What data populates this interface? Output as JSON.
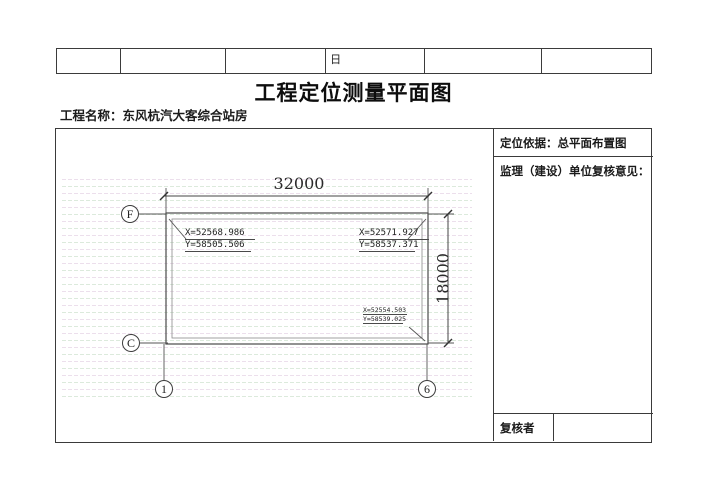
{
  "header_table": {
    "cells": [
      "",
      "",
      "",
      "日",
      "",
      ""
    ]
  },
  "title": "工程定位测量平面图",
  "project": {
    "label": "工程名称：",
    "name": "东风杭汽大客综合站房"
  },
  "drawing": {
    "dim_width": "32000",
    "dim_height": "18000",
    "axes": {
      "row_top": "F",
      "row_bottom": "C",
      "col_left": "1",
      "col_right": "6"
    },
    "coords": {
      "top_left": {
        "x": "X=52568.986",
        "y": "Y=58505.506"
      },
      "top_right": {
        "x": "X=52571.927",
        "y": "Y=58537.371"
      },
      "bottom_right": {
        "x": "X=52554.503",
        "y": "Y=58539.025"
      }
    }
  },
  "panel": {
    "basis": "定位依据：总平面布置图",
    "review_title": "监理（建设）单位复核意见：",
    "reviewer_label": "复核者",
    "reviewer_value": ""
  },
  "colors": {
    "line": "#3f3f3f",
    "hatch_pink": "#ecdfec",
    "hatch_green": "#dceadc"
  }
}
